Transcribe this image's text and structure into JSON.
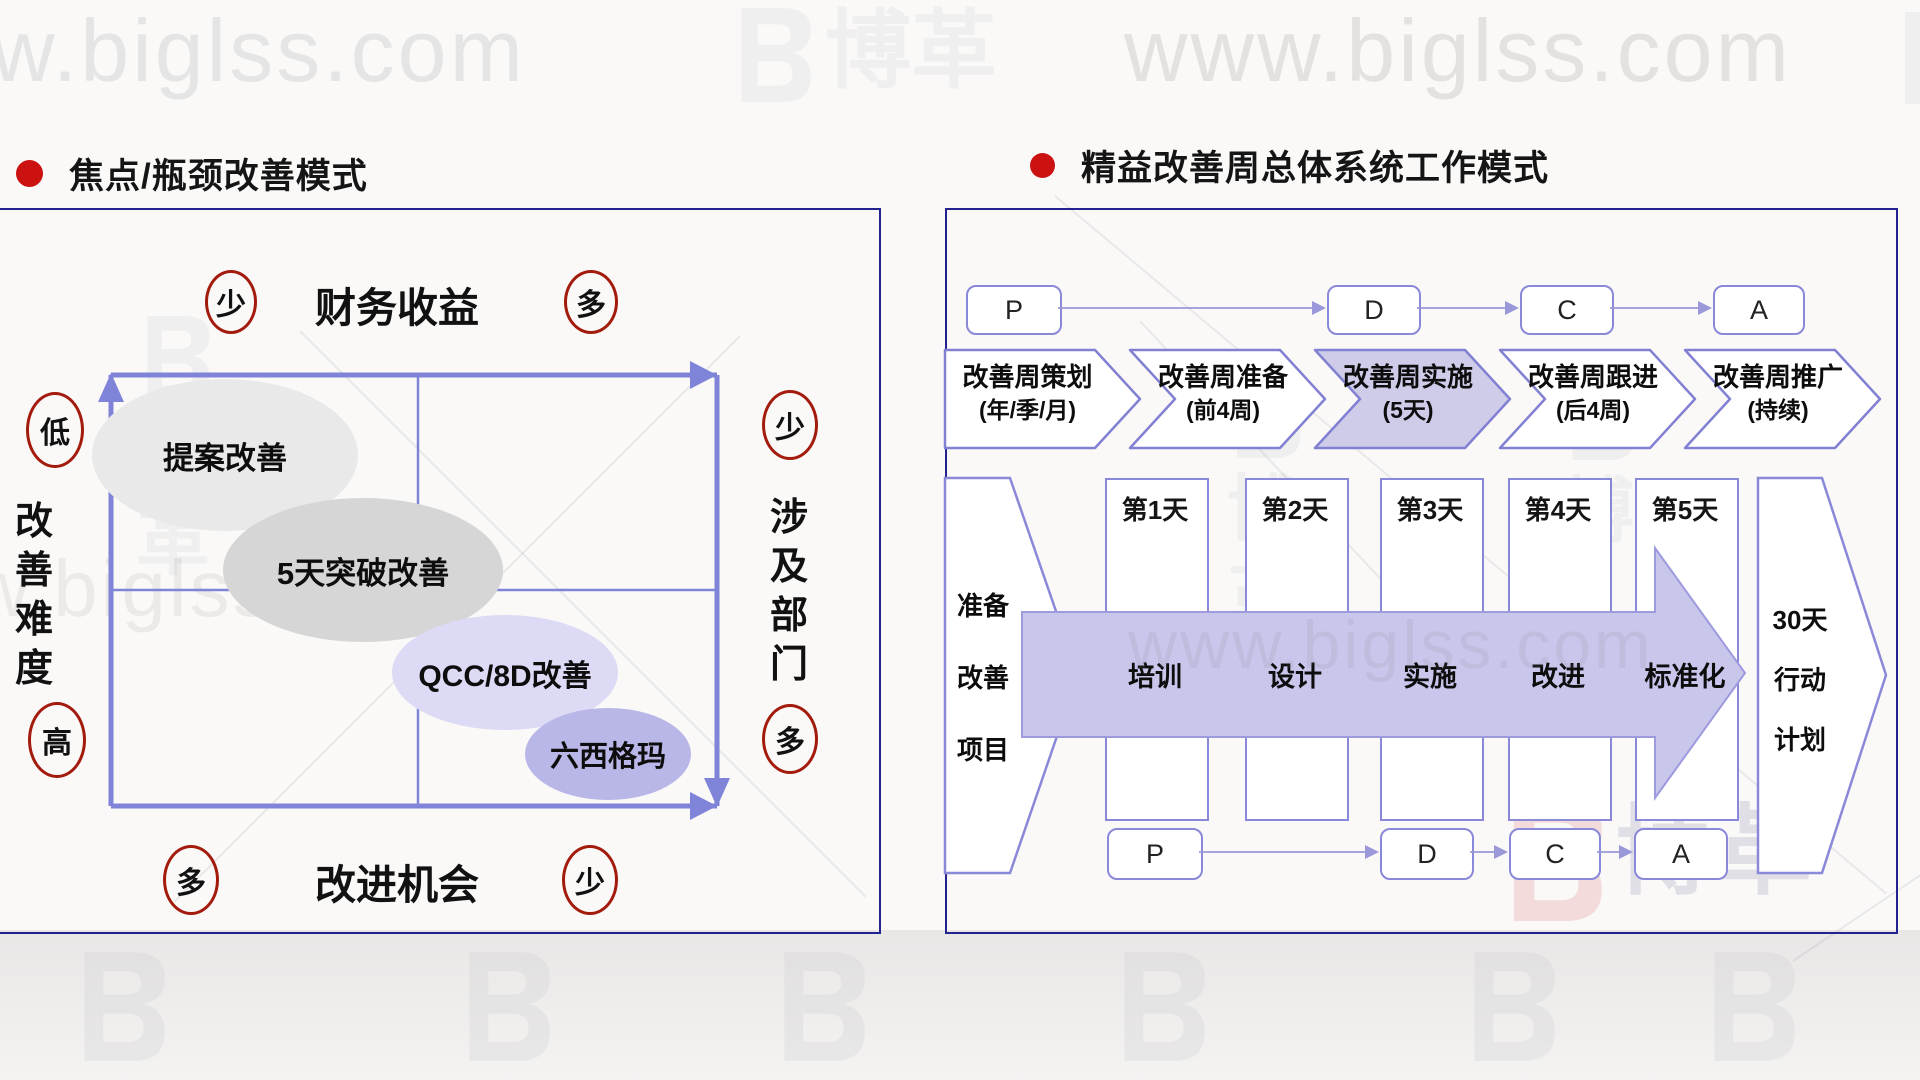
{
  "watermarks": {
    "site_top_left": "www.biglss.com",
    "site_top_right": "www.biglss.com",
    "site_mid_left": "www.biglss.com",
    "site_mid_right": "www.biglss.com",
    "logo_text": "博革",
    "logo_char_1": "博",
    "logo_char_2": "革"
  },
  "left_panel": {
    "title": "焦点/瓶颈改善模式",
    "matrix": {
      "top_axis": {
        "label": "财务收益",
        "left": "少",
        "right": "多"
      },
      "bottom_axis": {
        "label": "改进机会",
        "left": "多",
        "right": "少"
      },
      "left_axis": {
        "label": "改善难度",
        "top": "低",
        "bottom": "高"
      },
      "right_axis": {
        "label": "涉及部门",
        "top": "少",
        "bottom": "多"
      }
    },
    "bubbles": [
      {
        "label": "提案改善",
        "fill": "#e9e9e9"
      },
      {
        "label": "5天突破改善",
        "fill": "#d6d6d6"
      },
      {
        "label": "QCC/8D改善",
        "fill": "#dcdaf4"
      },
      {
        "label": "六西格玛",
        "fill": "#b9b6e8"
      }
    ]
  },
  "right_panel": {
    "title": "精益改善周总体系统工作模式",
    "pdca_top": [
      "P",
      "D",
      "C",
      "A"
    ],
    "phases": [
      {
        "line1": "改善周策划",
        "line2": "(年/季/月)",
        "highlighted": false
      },
      {
        "line1": "改善周准备",
        "line2": "(前4周)",
        "highlighted": false
      },
      {
        "line1": "改善周实施",
        "line2": "(5天)",
        "highlighted": true
      },
      {
        "line1": "改善周跟进",
        "line2": "(后4周)",
        "highlighted": false
      },
      {
        "line1": "改善周推广",
        "line2": "(持续)",
        "highlighted": false
      }
    ],
    "week": {
      "left_shape": [
        "准备",
        "改善",
        "项目"
      ],
      "days": [
        {
          "day": "第1天",
          "activity": "培训"
        },
        {
          "day": "第2天",
          "activity": "设计"
        },
        {
          "day": "第3天",
          "activity": "实施"
        },
        {
          "day": "第4天",
          "activity": "改进"
        },
        {
          "day": "第5天",
          "activity": "标准化"
        }
      ],
      "right_shape": [
        "30天",
        "行动",
        "计划"
      ]
    },
    "pdca_bottom": [
      "P",
      "D",
      "C",
      "A"
    ]
  },
  "colors": {
    "accent_red": "#cc1111",
    "circle_stroke": "#a31b0d",
    "matrix_line": "#8084d8",
    "shape_border": "#8a88d8",
    "chevron_highlight_fill": "#cfccea",
    "big_arrow_fill": "#c9c6ec",
    "panel_border": "#23238f",
    "background": "#faf9f8"
  }
}
